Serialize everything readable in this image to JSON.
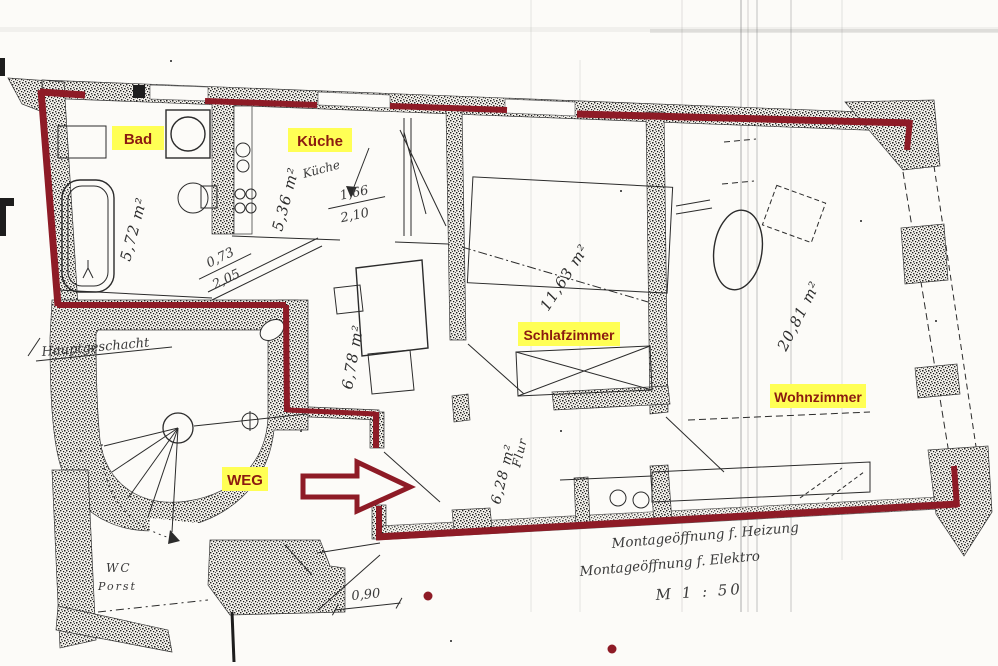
{
  "colors": {
    "boundary_red": "#8e1b26",
    "highlight_yellow": "#ffff55",
    "label_red": "#8b1a10",
    "ink": "#1d1d1d",
    "paper": "#fcfbf8"
  },
  "rooms": {
    "bad": {
      "label": "Bad",
      "area": "5,72 m²"
    },
    "kueche": {
      "label": "Küche",
      "area": "5,36 m²",
      "scribble": "Küche"
    },
    "schlafzimmer": {
      "label": "Schlafzimmer",
      "area": "11,63 m²"
    },
    "wohnzimmer": {
      "label": "Wohnzimmer",
      "area": "20,81 m²"
    },
    "flur": {
      "label": "Flur",
      "area": "6,28 m²"
    },
    "room_center": {
      "area": "6,78 m²"
    },
    "weg": {
      "label": "WEG"
    },
    "wc": {
      "line1": "WC",
      "line2": "Porst"
    }
  },
  "dimensions": {
    "door_bad": {
      "width": "0,73",
      "height": "2,05"
    },
    "door_kueche": {
      "width": "1,66",
      "height": "2,10"
    },
    "door_bottom": "0,90"
  },
  "annotations": {
    "stair_note": "Hauptgeschacht",
    "note_line1": "Montageöffnung f. Heizung",
    "note_line2": "Montageöffnung f. Elektro",
    "scale": "M 1 : 50"
  }
}
